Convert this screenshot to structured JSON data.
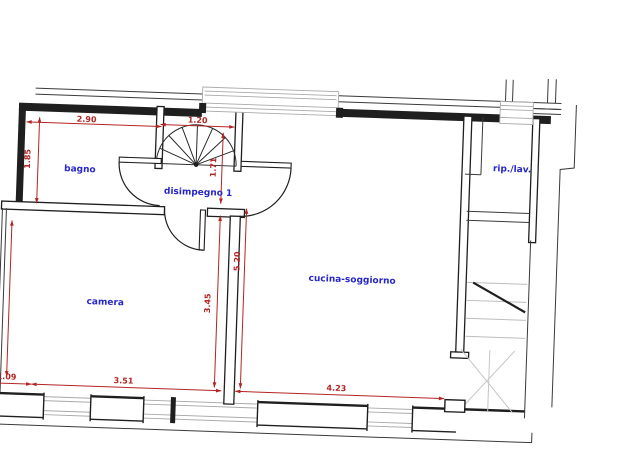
{
  "document": {
    "kind": "architectural floor plan",
    "units": "m"
  },
  "colors": {
    "wall": "#1f1f1f",
    "dimension_red": "#b32424",
    "room_label_blue": "#2626c9",
    "window_gray": "#a9a9a9",
    "stair_tread_gray": "#bdbdbd"
  },
  "rooms": [
    {
      "id": "bagno",
      "label": "bagno"
    },
    {
      "id": "disimpegno",
      "label": "disimpegno 1"
    },
    {
      "id": "camera",
      "label": "camera"
    },
    {
      "id": "cucina_soggiorno",
      "label": "cucina-soggiorno"
    },
    {
      "id": "rip_lav",
      "label": "rip./lav."
    }
  ],
  "dimensions": {
    "bagno_width": "2.90",
    "bagno_height": "1.85",
    "spiral_stair_width": "1.20",
    "disimpegno_height": "1.71",
    "camera_height": "3.45",
    "cucina_height": "5.20",
    "bottom_offset": "1.09",
    "camera_width": "3.51",
    "cucina_width": "4.23",
    "left_edge_clipped": "3.45"
  },
  "features": [
    "spiral-staircase",
    "straight-staircase",
    "door-swings",
    "windows-top-wall",
    "windows-bottom-wall"
  ]
}
